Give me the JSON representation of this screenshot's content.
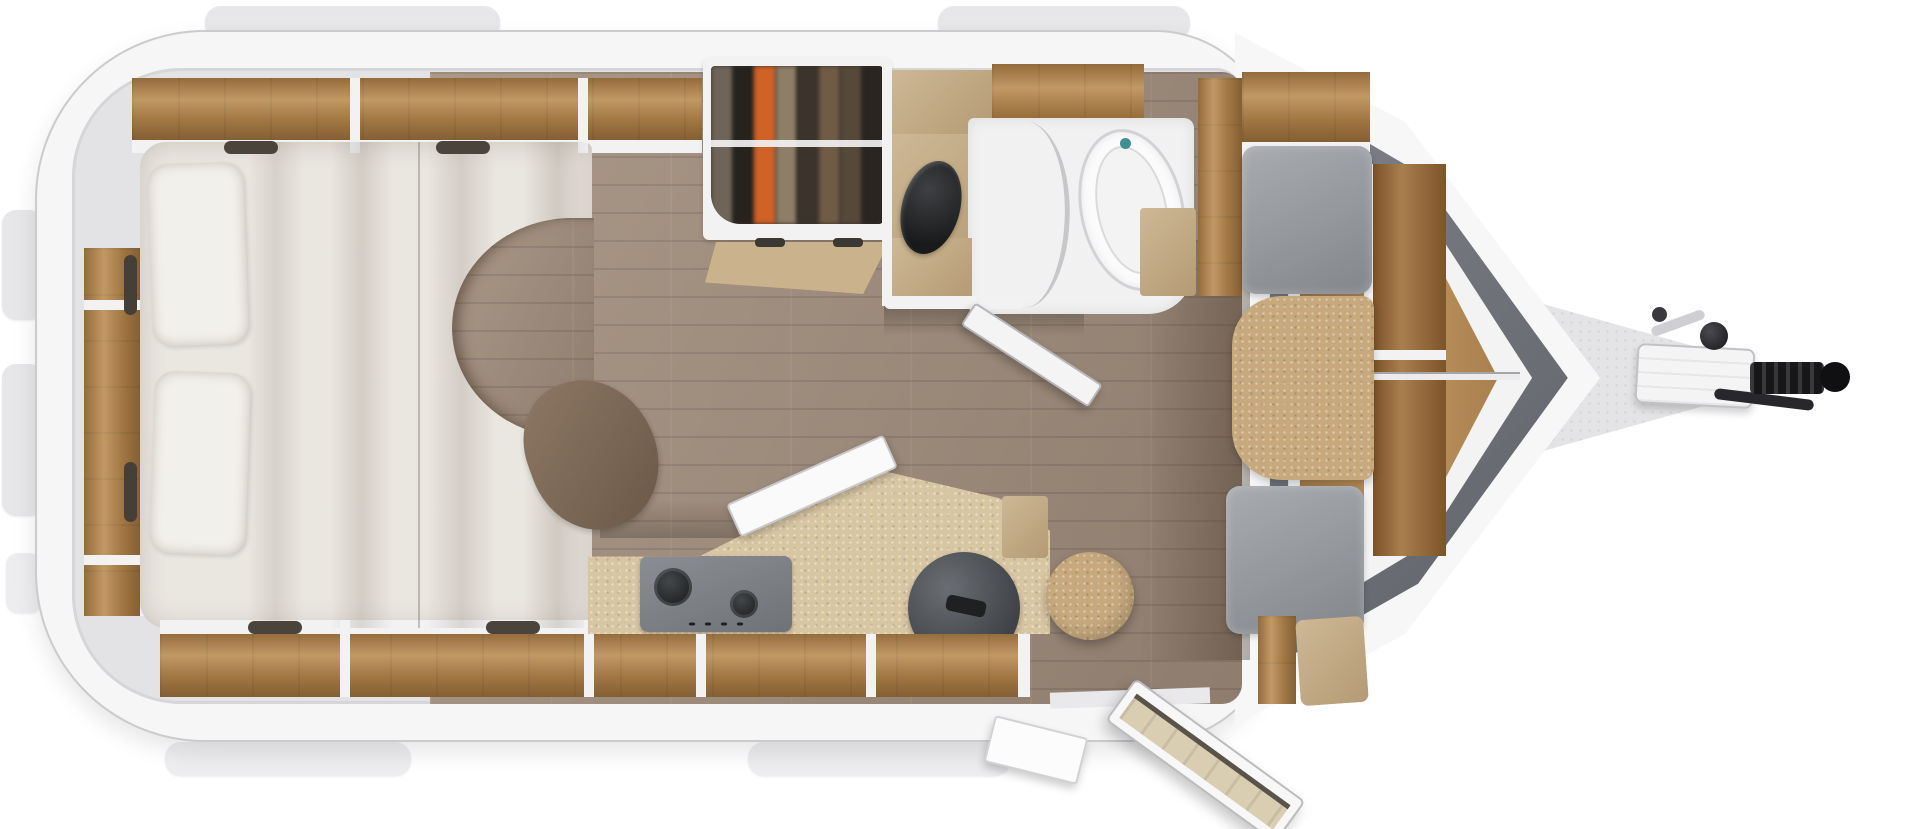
{
  "figure": {
    "kind": "caravan-travel-trailer-floorplan",
    "view": "top-down",
    "text_visible": "none"
  },
  "palette": {
    "background": "#ffffff",
    "body_shell": "#f6f6f7",
    "wall_outline": "#cbcbce",
    "wall_lining": "#e3e3e6",
    "roof_tab": "#e7e7e9",
    "wood_cabinet": "#b3874f",
    "wood_dark": "#9a6c3c",
    "trim_white": "#f2f2f3",
    "floor_wood": "#a28e7d",
    "mattress": "#eae6e0",
    "pillow": "#f2f0ea",
    "throw_brown": "#6a5847",
    "wardrobe_interior": "#352f29",
    "wardrobe_orange": "#d06227",
    "bath_cabinet_tan": "#c3a87e",
    "shower_floor": "#f1f1f1",
    "toilet_white": "#fbfbfc",
    "basin_black": "#191a1b",
    "accent_teal": "#418f91",
    "counter_cork": "#d8c5a2",
    "hob_gray": "#6f7377",
    "sink_gray": "#3f4246",
    "upholstery_gray": "#83868b",
    "cushion_cork": "#c7a97d",
    "nose_band_dark": "#5a5e64",
    "drawbar_gray": "#e4e4e6",
    "hitch_black": "#17171a"
  },
  "elements": [
    "rear-shelf",
    "french-bed",
    "pillow",
    "duvet",
    "throw-blanket",
    "overhead-lockers-top",
    "overhead-lockers-bottom",
    "cabinet-handles",
    "wardrobe-hanging-clothes",
    "washroom",
    "washbasin",
    "toilet",
    "shower-screen",
    "washroom-door-open",
    "kitchen-counter",
    "gas-hob",
    "kitchen-sink",
    "open-cabinet-flap",
    "stool",
    "wood-plank-floor",
    "dinette-bench-front",
    "dinette-bench-rear",
    "dinette-table",
    "front-shelf",
    "v-front-window-band",
    "entrance-door-open",
    "entry-step",
    "drawbar",
    "hitch-coupling",
    "handbrake-knob",
    "jockey-wheel-handle",
    "roof-rails",
    "bumper-rails"
  ]
}
